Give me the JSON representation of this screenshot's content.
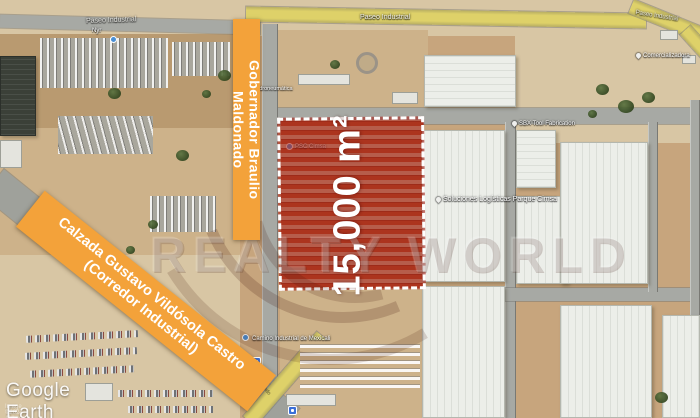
{
  "banners": {
    "vertical_street": "Gobernador Braulio Maldonado",
    "diagonal_street_line1": "Calzada Gustavo Vildósola Castro",
    "diagonal_street_line2": "(Corredor Industrial)"
  },
  "parcel": {
    "area_label": "15,000 m²"
  },
  "watermark": {
    "text": "REALTY WORLD"
  },
  "road_labels": {
    "paseo_left": "Paseo Industrial",
    "paseo_center": "Paseo Industrial",
    "paseo_right": "Paseo Industrial",
    "street_bottom": "Braulio Maldonado"
  },
  "poi_labels": {
    "parcel_poi": "PSC Cimsa",
    "logistics": "Soluciones Logísticas Parque Cimsa",
    "tool": "SBX Tool Fabrication",
    "comercial": "Comercializadora",
    "bottom": "Camino Industrial de Mexicali",
    "north_small": "Nyr",
    "hidro": "Hidroneumática"
  },
  "attribution": {
    "brand": "Google Earth",
    "credit": "Image ©2024 Airbus"
  },
  "colors": {
    "banner_orange": "#F3A23A",
    "parcel_red": "#A82118",
    "road_yellow": "#DED169"
  }
}
